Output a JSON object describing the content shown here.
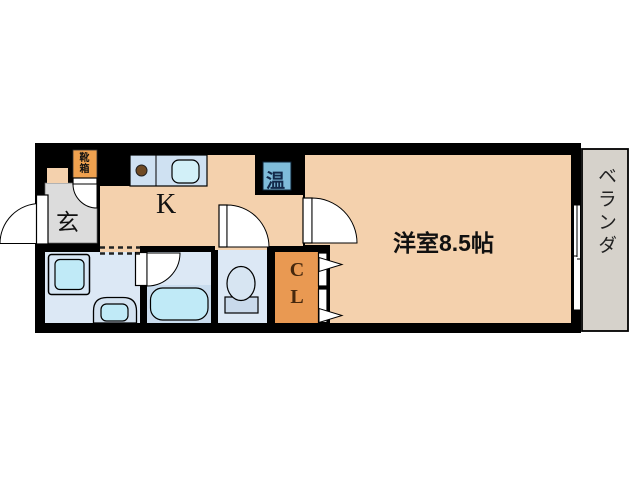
{
  "floor_plan": {
    "entrance_label": "玄",
    "kitchen_label": "K",
    "main_room_label": "洋室8.5帖",
    "veranda_label": "ベランダ",
    "closet_label": "CL",
    "water_heater_label": "温",
    "shoe_box_label": "靴箱"
  },
  "colors": {
    "wall": "#000000",
    "floor-peach": "#f4d1ad",
    "entrance-gray": "#dcdcdc",
    "room-blue": "#dce8f5",
    "counter-blue": "#cfe1f2",
    "fixture-cyan": "#c0eaf7",
    "tub-band-blue": "#c9dcee",
    "washer-blue": "#d7e7f5",
    "toilet-blue": "#d7e5f2",
    "toilet-base-blue": "#c9d9eb",
    "closet-orange": "#e99952",
    "shoebox-orange": "#efa14f",
    "heater-blue": "#7fbcda",
    "veranda-gray": "#d6d2cb",
    "stove-brown": "#6f4a24",
    "door-white": "#ffffff"
  }
}
